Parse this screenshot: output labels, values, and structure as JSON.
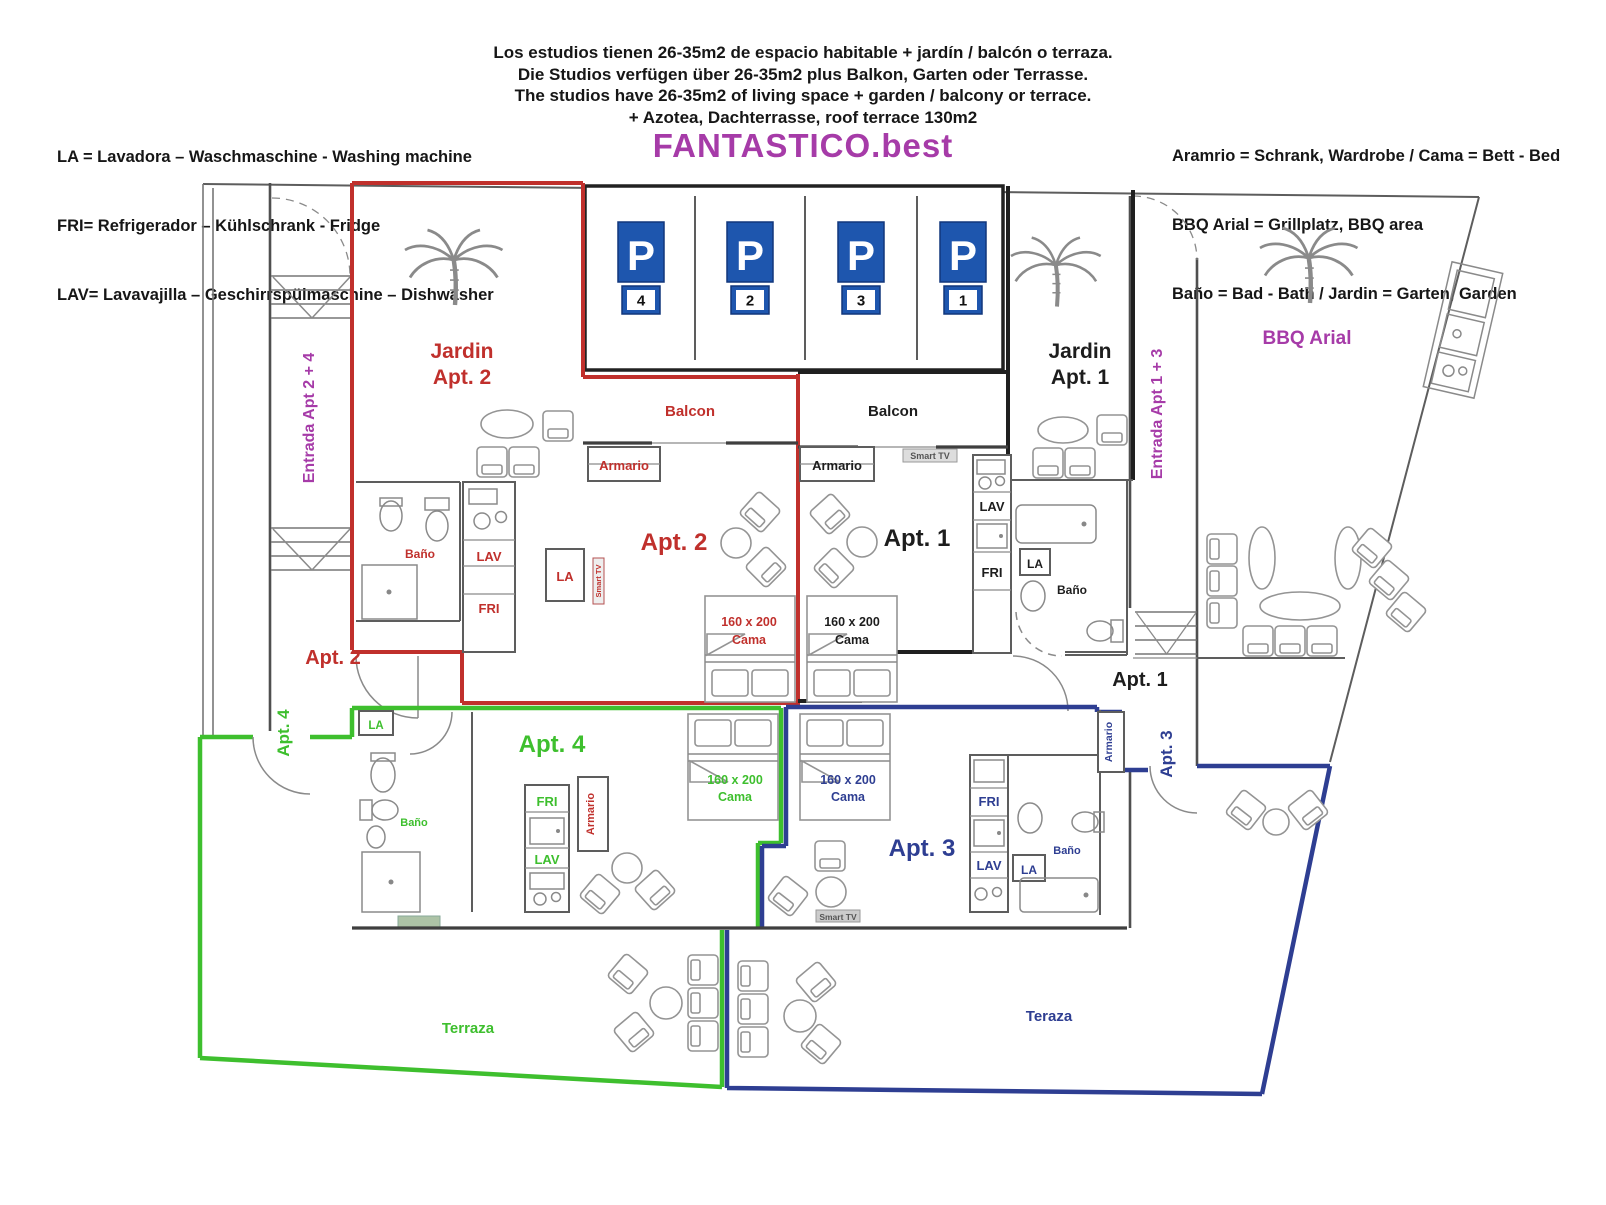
{
  "header": {
    "legend_left": [
      "LA = Lavadora – Waschmaschine - Washing machine",
      "FRI= Refrigerador – Kühlschrank - Fridge",
      "LAV= Lavavajilla – Geschirrspülmaschine – Dishwasher"
    ],
    "intro": [
      "Los estudios tienen 26-35m2 de espacio habitable + jardín / balcón o terraza.",
      "Die Studios verfügen über 26-35m2 plus Balkon, Garten oder Terrasse.",
      "The studios have 26-35m2 of living space + garden / balcony or terrace.",
      "+ Azotea, Dachterrasse, roof terrace 130m2"
    ],
    "brand": "FANTASTICO.best",
    "legend_right": [
      "Aramrio = Schrank, Wardrobe / Cama = Bett - Bed",
      "BBQ Arial = Grillplatz, BBQ area",
      "Baño = Bad - Bath / Jardin = Garten, Garden"
    ]
  },
  "colors": {
    "apt1": "#1f1f1f",
    "apt2": "#c0302c",
    "apt3": "#2e3e92",
    "apt4": "#3ebf2e",
    "purple": "#a63ba8",
    "pblue": "#1e56ae"
  },
  "parking": {
    "sign": "P",
    "spots": [
      "4",
      "2",
      "3",
      "1"
    ]
  },
  "areas": {
    "entrada_24": "Entrada Apt 2 + 4",
    "entrada_13": "Entrada Apt 1 + 3",
    "jardin_apt2": {
      "line1": "Jardin",
      "line2": "Apt. 2"
    },
    "jardin_apt1": {
      "line1": "Jardin",
      "line2": "Apt. 1"
    },
    "bbq": "BBQ Arial",
    "terraza_apt4": "Terraza",
    "teraza_apt3": "Teraza"
  },
  "apts": {
    "apt2": {
      "name": "Apt. 2",
      "door": "Apt. 2",
      "balcon": "Balcon",
      "armario": "Armario",
      "bano": "Baño",
      "la": "LA",
      "lav": "LAV",
      "fri": "FRI",
      "smart_tv": "Smart TV",
      "bed_size": "160 x 200",
      "bed_word": "Cama"
    },
    "apt1": {
      "name": "Apt. 1",
      "door": "Apt. 1",
      "balcon": "Balcon",
      "armario": "Armario",
      "bano": "Baño",
      "la": "LA",
      "lav": "LAV",
      "fri": "FRI",
      "smart_tv": "Smart TV",
      "bed_size": "160 x 200",
      "bed_word": "Cama"
    },
    "apt4": {
      "name": "Apt. 4",
      "door": "Apt. 4",
      "armario": "Armario",
      "bano": "Baño",
      "la": "LA",
      "lav": "LAV",
      "fri": "FRI",
      "smart_tv": "Smart TV",
      "bed_size": "160 x 200",
      "bed_word": "Cama"
    },
    "apt3": {
      "name": "Apt. 3",
      "door": "Apt. 3",
      "armario": "Armario",
      "bano": "Baño",
      "la": "LA",
      "lav": "LAV",
      "fri": "FRI",
      "smart_tv": "Smart TV",
      "bed_size": "160 x 200",
      "bed_word": "Cama"
    }
  }
}
